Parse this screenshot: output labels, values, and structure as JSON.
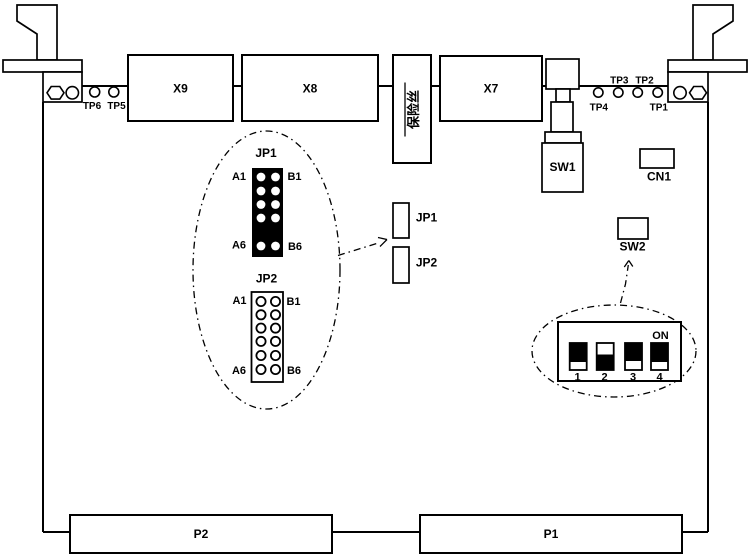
{
  "board": {
    "connector_x9": "X9",
    "connector_x8": "X8",
    "connector_x7": "X7",
    "connector_p2": "P2",
    "connector_p1": "P1",
    "fuse_label": "保险丝",
    "sw1_label": "SW1",
    "cn1_label": "CN1",
    "sw2_label": "SW2",
    "jp1_label": "JP1",
    "jp2_label": "JP2",
    "test_points": {
      "tp1": "TP1",
      "tp2": "TP2",
      "tp3": "TP3",
      "tp4": "TP4",
      "tp5": "TP5",
      "tp6": "TP6"
    }
  },
  "jumper_detail": {
    "jp1": {
      "title": "JP1",
      "pin_top_left": "A1",
      "pin_top_right": "B1",
      "pin_bottom_left": "A6",
      "pin_bottom_right": "B6",
      "columns": 2,
      "style": "filled-black-header"
    },
    "jp2": {
      "title": "JP2",
      "pin_top_left": "A1",
      "pin_top_right": "B1",
      "pin_bottom_left": "A6",
      "pin_bottom_right": "B6",
      "columns": 2,
      "style": "open-outline-header"
    }
  },
  "dip_switch_detail": {
    "on_label": "ON",
    "positions": [
      {
        "number": "1",
        "state": "up"
      },
      {
        "number": "2",
        "state": "down"
      },
      {
        "number": "3",
        "state": "up"
      },
      {
        "number": "4",
        "state": "up"
      }
    ]
  },
  "colors": {
    "line": "#000000",
    "background": "#ffffff"
  }
}
